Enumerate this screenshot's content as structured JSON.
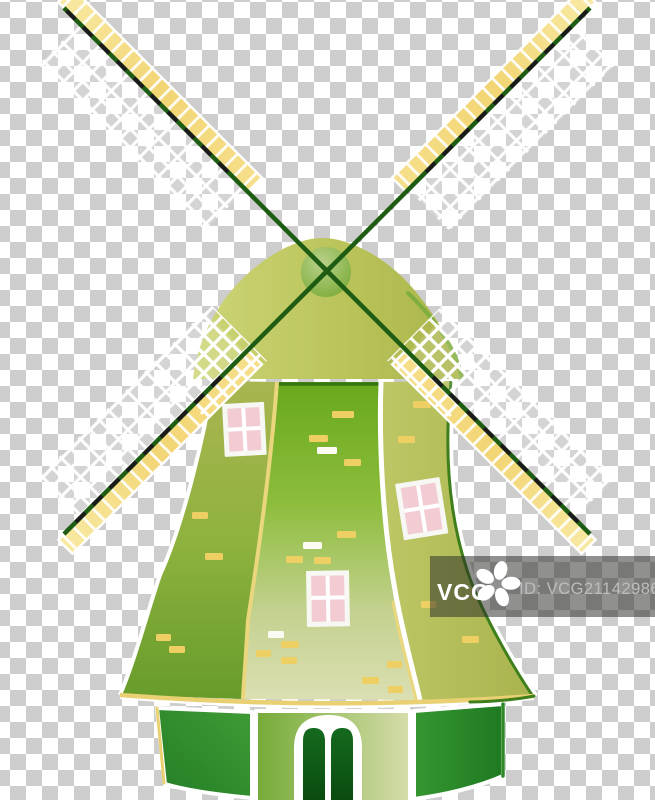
{
  "background": {
    "checker_light": "#ffffff",
    "checker_dark": "#cdcdcd",
    "square_px": 16
  },
  "windmill": {
    "colors": {
      "white": "#ffffff",
      "cap_light": "#cdd577",
      "cap_mid": "#bac45a",
      "cap_dark": "#a9b44a",
      "cap_edge_green": "#7fae3f",
      "hub_light": "#b9d394",
      "hub_dark": "#67a42c",
      "spar_green": "#1d5c12",
      "spar_dash": "#1a1a1a",
      "blade_bar_tip": "#f8e9a2",
      "blade_bar_mid": "#f2d574",
      "blade_bar_inner": "#f6df8b",
      "sail_veil": "rgba(255,255,255,0.15)",
      "left_top": "#a9b550",
      "left_mid": "#8fb23e",
      "left_bottom": "#679c2b",
      "center_top": "#68a81d",
      "center_upper": "#8dbd3c",
      "center_lower": "#c3d18f",
      "center_bottom": "#dcdfb2",
      "right_light": "#bdc765",
      "right_dark": "#a9b44e",
      "sep_yellow": "#ead67d",
      "trim_yellow": "#e9d173",
      "top_shadow_green": "#35760f",
      "edge_green": "#3e7f1c",
      "window_frame": "#f7f7f3",
      "window_pane": "#f2ccd2",
      "base_left_light": "#3f9c35",
      "base_left_dark": "#247e26",
      "base_center_light": "#74ab36",
      "base_center_pale": "#d7ddab",
      "base_right_light": "#359631",
      "base_right_dark": "#1f7a22",
      "base_edge_green": "#2e8a26",
      "door_top": "#156a1d",
      "door_bottom": "#0a4a10",
      "brick_yellow": "#eecf63",
      "brick_white": "#fbfbf4"
    },
    "bricks": [
      [
        332,
        411,
        22,
        "y"
      ],
      [
        309,
        435,
        19,
        "y"
      ],
      [
        317,
        447,
        20,
        "w"
      ],
      [
        344,
        459,
        17,
        "y"
      ],
      [
        337,
        531,
        19,
        "y"
      ],
      [
        303,
        542,
        19,
        "w"
      ],
      [
        286,
        556,
        17,
        "y"
      ],
      [
        314,
        557,
        17,
        "y"
      ],
      [
        268,
        631,
        16,
        "w"
      ],
      [
        281,
        641,
        18,
        "y"
      ],
      [
        256,
        650,
        15,
        "y"
      ],
      [
        281,
        657,
        16,
        "y"
      ],
      [
        387,
        661,
        15,
        "y"
      ],
      [
        362,
        677,
        17,
        "y"
      ],
      [
        388,
        686,
        15,
        "y"
      ],
      [
        192,
        512,
        16,
        "y"
      ],
      [
        205,
        553,
        18,
        "y"
      ],
      [
        156,
        634,
        15,
        "y"
      ],
      [
        169,
        646,
        16,
        "y"
      ],
      [
        413,
        401,
        18,
        "y"
      ],
      [
        398,
        436,
        17,
        "y"
      ],
      [
        421,
        601,
        15,
        "y"
      ],
      [
        462,
        636,
        17,
        "y"
      ]
    ]
  },
  "watermark": {
    "brand": "VCG",
    "id_text": "ID: VCG211429868026",
    "overlay": "rgba(43,44,38,0.52)",
    "brand_color": "#ffffff",
    "id_color": "#bdbdbd",
    "flower_color": "#ffffff",
    "logo": "pinwheel-flower-icon"
  }
}
